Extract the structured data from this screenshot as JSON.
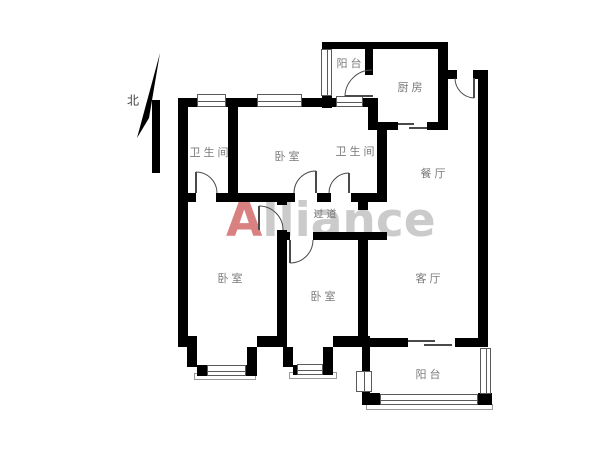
{
  "compass": {
    "label": "北"
  },
  "watermark": {
    "first_letter": "A",
    "rest": "lliance"
  },
  "rooms": {
    "balcony_top": {
      "label": "阳台"
    },
    "kitchen": {
      "label": "厨房"
    },
    "bathroom_1": {
      "label": "卫生间"
    },
    "bedroom_top": {
      "label": "卧室"
    },
    "bathroom_2": {
      "label": "卫生间"
    },
    "dining": {
      "label": "餐厅"
    },
    "hallway": {
      "label": "过道"
    },
    "bedroom_left": {
      "label": "卧室"
    },
    "bedroom_mid": {
      "label": "卧室"
    },
    "living": {
      "label": "客厅"
    },
    "balcony_bottom": {
      "label": "阳台"
    }
  },
  "colors": {
    "wall": "#000000",
    "room_label": "#7a7a7a",
    "watermark_gray": "#cbcbcb",
    "watermark_red": "#d98080",
    "thin_line": "#555555"
  }
}
